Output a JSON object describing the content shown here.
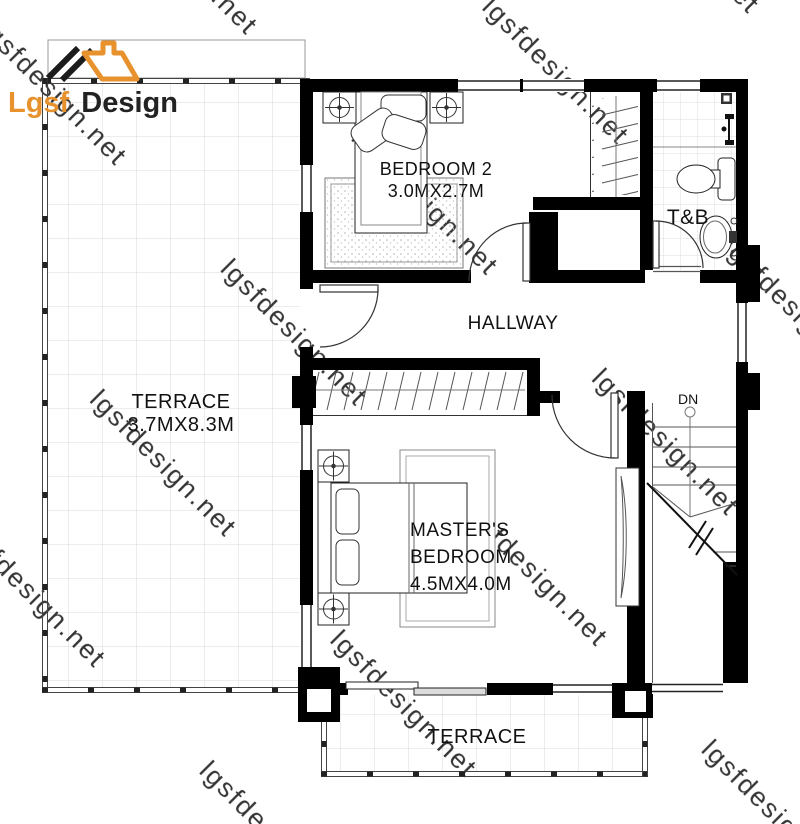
{
  "logo": {
    "brand": "Lgsf",
    "brand2": "Design"
  },
  "watermark": {
    "text": "lgsfdesign.net"
  },
  "labels": {
    "terrace_left": {
      "name": "TERRACE",
      "dims": "3.7MX8.3M"
    },
    "bedroom2": {
      "name": "BEDROOM 2",
      "dims": "3.0MX2.7M"
    },
    "toilet_bath": {
      "name": "T&B"
    },
    "hallway": {
      "name": "HALLWAY"
    },
    "master_bedroom": {
      "name_line1": "MASTER'S",
      "name_line2": "BEDROOM",
      "dims": "4.5MX4.0M"
    },
    "terrace_bottom": {
      "name": "TERRACE"
    },
    "stairs": {
      "direction": "DN"
    }
  },
  "colors": {
    "wall": "#000000",
    "logo_orange": "#e8922e",
    "logo_dark": "#222222",
    "watermark_gray": "#c2c2c2",
    "tile_line": "#d9d9d9",
    "label_text": "#111111"
  }
}
